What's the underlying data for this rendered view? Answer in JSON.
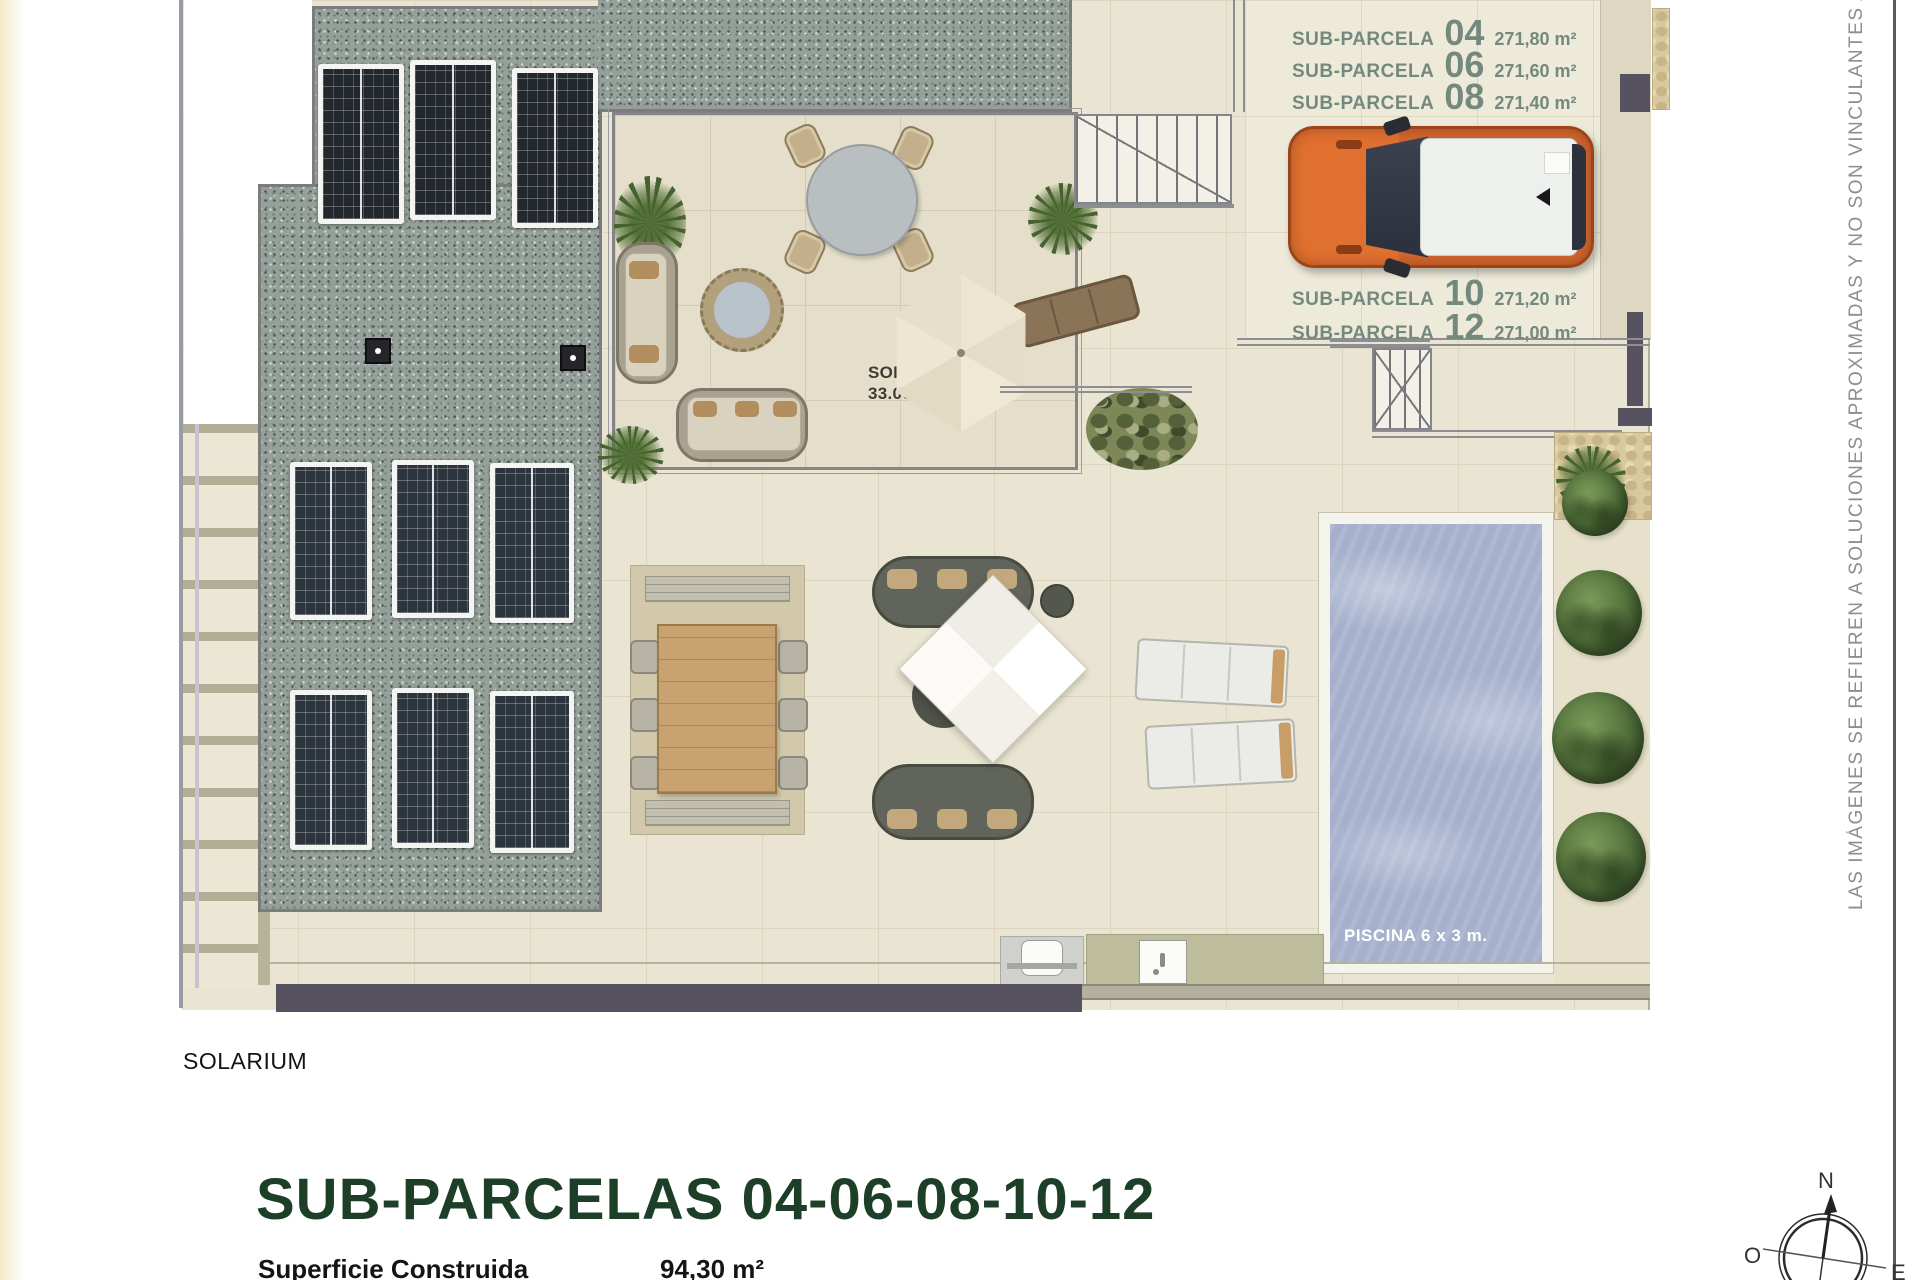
{
  "annotations": {
    "side_note": "LAS IMÁGENES SE REFIEREN A SOLUCIONES APROXIMADAS Y NO SON VINCULANTES AL PROYECTO"
  },
  "plan": {
    "solarium": {
      "label": "SOLARIUM",
      "area": "33.00 m²"
    },
    "pool": {
      "label": "PISCINA 6 x 3 m."
    },
    "subparcels": [
      {
        "label": "SUB-PARCELA",
        "number": "04",
        "area": "271,80 m²"
      },
      {
        "label": "SUB-PARCELA",
        "number": "06",
        "area": "271,60 m²"
      },
      {
        "label": "SUB-PARCELA",
        "number": "08",
        "area": "271,40 m²"
      },
      {
        "label": "SUB-PARCELA",
        "number": "10",
        "area": "271,20 m²"
      },
      {
        "label": "SUB-PARCELA",
        "number": "12",
        "area": "271,00 m²"
      }
    ]
  },
  "footer": {
    "floor_label": "SOLARIUM",
    "title": "SUB-PARCELAS 04-06-08-10-12",
    "surface_label": "Superficie Construida",
    "surface_value": "94,30 m²"
  },
  "compass": {
    "north": "N",
    "west": "O",
    "east": "E"
  },
  "colors": {
    "title-green": "#1d3f28",
    "parcel-green": "#74897e",
    "car-orange": "#d2652e",
    "pool-blue": "#a6b0cc",
    "wall-dark": "#57525f"
  }
}
